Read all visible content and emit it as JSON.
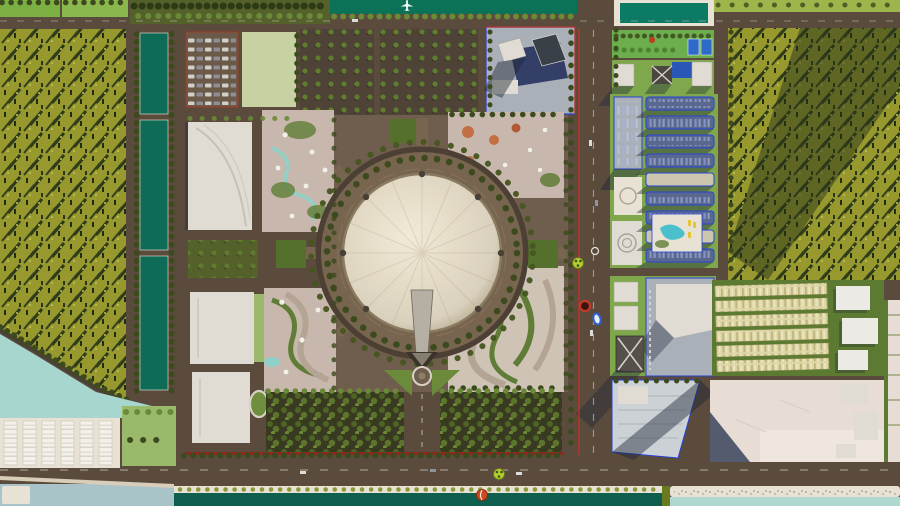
{
  "scene": {
    "type": "aerial-3d-masterplan-render",
    "subject": "Urban master plan with central circular dome exhibition hall, surrounded by parks, orchards, forest, canals, apartment district and waterfront",
    "elements": [
      "north-river",
      "airplane",
      "west-forest",
      "west-canal-strips",
      "central-dome-plaza",
      "entrance-spire",
      "fountain",
      "orchard-blocks",
      "exhibition-halls",
      "tent-park",
      "terraced-gardens",
      "tree-plantations",
      "east-boulevard",
      "apartment-grid",
      "tower-block",
      "row-houses",
      "development-parcels",
      "south-canal",
      "lakefront-warehouses"
    ]
  },
  "palette": {
    "road": "#5a4b3d",
    "roadDark": "#4c4034",
    "curb": "#d8d2c4",
    "square": "#6f5e4d",
    "forestBase": "#97992f",
    "forestTree": "#212d12",
    "forestStreak": "#2e3a18",
    "forestLight": "#c2c455",
    "fieldBright": "#7cb043",
    "fieldBright2": "#8ab84d",
    "fieldPale": "#c6d2a2",
    "lawn": "#9ab96a",
    "lawnDark": "#5d7a33",
    "parkGreen": "#6cae4e",
    "gridLawn": "#7fa74b",
    "grass2": "#9eb54b",
    "plantBase": "#3a3a22",
    "orchardSoil": "#4e4336",
    "orchardTree": "#5f7d2e",
    "treeDot": "#3c4a1e",
    "treeBright": "#6a8a38",
    "shrub": "#8a9a3a",
    "hedgeDark": "#6a7a1e",
    "canal": "#0e6b55",
    "river": "#0c7257",
    "pool": "#0d7a66",
    "poolBlue": "#2857b8",
    "poolAqua": "#49c0cc",
    "aqua": "#a7d6cf",
    "waterGray": "#a9c4c8",
    "canalDark": "#0f5f4e",
    "seafoam": "#aed8d0",
    "sand": "#d8cdb8",
    "embank": "#e8e2d4",
    "streamBlue": "#8fd0c8",
    "domeHi": "#f2ead6",
    "domeMid": "#d9d0bd",
    "domeLo": "#b3a588",
    "domeRim": "#8a7a60",
    "plaza": "#78654f",
    "bldg": "#e0dcd4",
    "bldgLine": "#c6c1b8",
    "bldgDark": "#4a4640",
    "glass": "#27335e",
    "blockGray": "#aab0b8",
    "slabFill": "#5a6890",
    "slabCream": "#ccc6ae",
    "blueLine": "#2742d8",
    "redLine": "#b93425",
    "redStrip": "#8a2a1e",
    "shadow": "#1e2636",
    "shadowOlive": "#28331a",
    "terrTan": "#cfc3b6",
    "terrDark": "#b3a494",
    "terrGreen": "#5f7d36",
    "grassV": "#6b8a3a",
    "tentGround": "#c8b7ad",
    "tentWhite": "#f2efe8",
    "playOrange": "#c2683a",
    "rowhouse": "#ddd6a6",
    "rowline": "#a59b64",
    "parcel": "#e7ddd5",
    "parcelLight": "#efe6df",
    "parcelShadow": "#39445c",
    "courtBlue": "#2e6bc8",
    "starRed": "#c23a24",
    "mkGreen": "#b7cc2f",
    "mkGreenDark": "#2e5c1e",
    "mkBlue": "#2b5fd9",
    "mkOrange": "#cc4a22",
    "mkWhite": "#e8e4dc",
    "carLight": "#dcdcd8",
    "carDark": "#8f949c",
    "white": "#f4f1ea",
    "gravelDot": "#b9ae98"
  },
  "markers": [
    {
      "name": "traffic-signal-marker-north",
      "color": "#b7cc2f"
    },
    {
      "name": "ring-marker-white",
      "color": "#e8e4dc"
    },
    {
      "name": "no-entry-marker",
      "color": "#c23a24"
    },
    {
      "name": "route-marker-blue",
      "color": "#2b5fd9"
    },
    {
      "name": "traffic-signal-marker-south",
      "color": "#b7cc2f"
    },
    {
      "name": "beachball-marker",
      "color": "#cc4a22"
    },
    {
      "name": "airplane-icon",
      "color": "#ffffff"
    }
  ]
}
